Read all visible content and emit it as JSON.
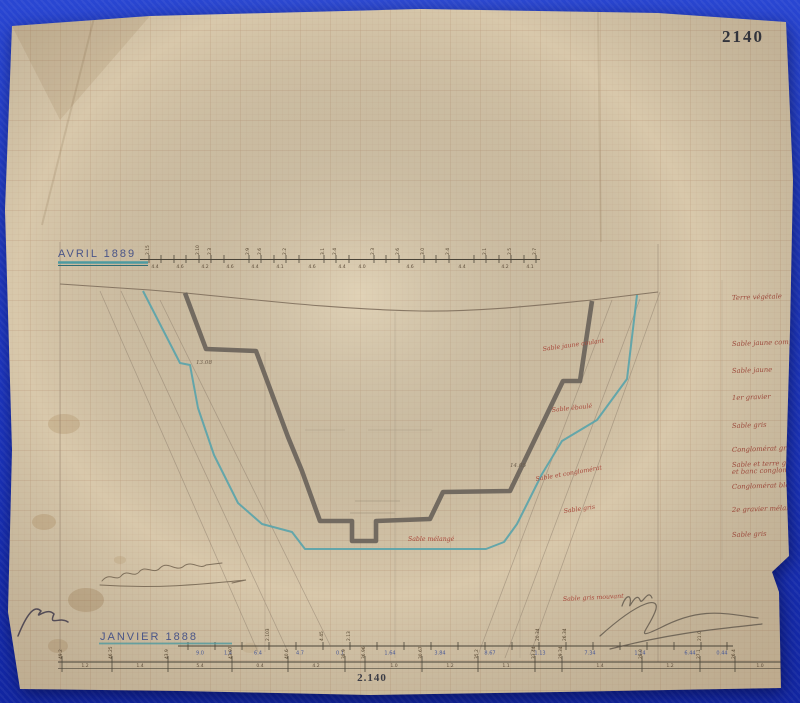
{
  "sheet": {
    "plate_number": "2140",
    "plate_number_footer": "2.140",
    "paper_color": "#d8c8ab",
    "grid_color": "#ab7a56",
    "backdrop_color": "#1d36c0",
    "profile_1888_color": "#6a635a",
    "profile_1889_color": "#58a3ab",
    "label_blue": "#4a5588",
    "label_red": "#9c4a3c"
  },
  "scales": {
    "top": {
      "label": "AVRIL 1889",
      "ticks": [
        149,
        161,
        174,
        186,
        199,
        211,
        224,
        249,
        261,
        274,
        286,
        299,
        324,
        336,
        349,
        374,
        386,
        399,
        424,
        436,
        449,
        474,
        486,
        499,
        511,
        524,
        536
      ],
      "upper": [
        {
          "x": 149,
          "v": "2.15"
        },
        {
          "x": 199,
          "v": "2.10"
        },
        {
          "x": 211,
          "v": "2.3"
        },
        {
          "x": 249,
          "v": "2.9"
        },
        {
          "x": 261,
          "v": "2.6"
        },
        {
          "x": 286,
          "v": "2.2"
        },
        {
          "x": 324,
          "v": "3.1"
        },
        {
          "x": 336,
          "v": "2.4"
        },
        {
          "x": 374,
          "v": "2.3"
        },
        {
          "x": 399,
          "v": "2.6"
        },
        {
          "x": 424,
          "v": "3.0"
        },
        {
          "x": 449,
          "v": "2.4"
        },
        {
          "x": 486,
          "v": "2.1"
        },
        {
          "x": 511,
          "v": "2.5"
        },
        {
          "x": 536,
          "v": "2.7"
        }
      ],
      "lower": [
        {
          "x": 155,
          "v": "4.4"
        },
        {
          "x": 180,
          "v": "4.6"
        },
        {
          "x": 205,
          "v": "4.2"
        },
        {
          "x": 230,
          "v": "4.6"
        },
        {
          "x": 255,
          "v": "4.4"
        },
        {
          "x": 280,
          "v": "4.1"
        },
        {
          "x": 312,
          "v": "4.6"
        },
        {
          "x": 342,
          "v": "4.4"
        },
        {
          "x": 362,
          "v": "4.0"
        },
        {
          "x": 410,
          "v": "4.6"
        },
        {
          "x": 462,
          "v": "4.4"
        },
        {
          "x": 505,
          "v": "4.2"
        },
        {
          "x": 530,
          "v": "4.1"
        }
      ]
    },
    "mid": {
      "label": "JANVIER 1888",
      "ticks": [
        188,
        215,
        242,
        269,
        296,
        323,
        350,
        377,
        404,
        431,
        458,
        485,
        512,
        539,
        566,
        593,
        620,
        647,
        674,
        701,
        727
      ],
      "below": [
        {
          "x": 200,
          "v": "9.0"
        },
        {
          "x": 228,
          "v": "1.4"
        },
        {
          "x": 258,
          "v": "6.4"
        },
        {
          "x": 300,
          "v": "4.7"
        },
        {
          "x": 340,
          "v": "0.1"
        },
        {
          "x": 390,
          "v": "1.64"
        },
        {
          "x": 440,
          "v": "3.84"
        },
        {
          "x": 490,
          "v": "8.67"
        },
        {
          "x": 540,
          "v": "1.13"
        },
        {
          "x": 590,
          "v": "7.34"
        },
        {
          "x": 640,
          "v": "1.14"
        },
        {
          "x": 690,
          "v": "6.44"
        },
        {
          "x": 722,
          "v": "0.44"
        }
      ],
      "above": [
        {
          "x": 269,
          "v": "2.103"
        },
        {
          "x": 323,
          "v": "4.45"
        },
        {
          "x": 350,
          "v": "2.13"
        },
        {
          "x": 539,
          "v": "20.34"
        },
        {
          "x": 566,
          "v": "26.34"
        },
        {
          "x": 701,
          "v": "21.0"
        }
      ]
    },
    "base": {
      "ticks": [
        62,
        112,
        168,
        232,
        288,
        345,
        365,
        422,
        478,
        535,
        562,
        642,
        700,
        735,
        790
      ],
      "rotated": [
        {
          "x": 62,
          "v": "49.2"
        },
        {
          "x": 112,
          "v": "46.25"
        },
        {
          "x": 168,
          "v": "43.9"
        },
        {
          "x": 232,
          "v": "43.97"
        },
        {
          "x": 288,
          "v": "40.6"
        },
        {
          "x": 345,
          "v": "38.9"
        },
        {
          "x": 365,
          "v": "36.96"
        },
        {
          "x": 422,
          "v": "30.67"
        },
        {
          "x": 478,
          "v": "35.2"
        },
        {
          "x": 535,
          "v": "33.44"
        },
        {
          "x": 562,
          "v": "29.34"
        },
        {
          "x": 642,
          "v": "28.0"
        },
        {
          "x": 700,
          "v": "27.1"
        },
        {
          "x": 735,
          "v": "26.4"
        },
        {
          "x": 790,
          "v": "25.42"
        }
      ],
      "inline": [
        {
          "x": 85,
          "v": "1.2"
        },
        {
          "x": 140,
          "v": "1.4"
        },
        {
          "x": 200,
          "v": "5.4"
        },
        {
          "x": 260,
          "v": "0.4"
        },
        {
          "x": 316,
          "v": "4.2"
        },
        {
          "x": 394,
          "v": "1.0"
        },
        {
          "x": 450,
          "v": "1.2"
        },
        {
          "x": 506,
          "v": "1.1"
        },
        {
          "x": 600,
          "v": "1.4"
        },
        {
          "x": 670,
          "v": "1.2"
        },
        {
          "x": 760,
          "v": "1.0"
        }
      ]
    }
  },
  "strata_labels": [
    {
      "y": 300,
      "text": "Terre végétale"
    },
    {
      "y": 346,
      "text": "Sable jaune compact"
    },
    {
      "y": 373,
      "text": "Sable jaune"
    },
    {
      "y": 400,
      "text": "1er gravier"
    },
    {
      "y": 428,
      "text": "Sable gris"
    },
    {
      "y": 452,
      "text": "Conglomérat gris"
    },
    {
      "y": 467,
      "text": "Sable et terre glaise"
    },
    {
      "y": 474,
      "text": "et banc conglomérat"
    },
    {
      "y": 489,
      "text": "Conglomérat bleuâtre"
    },
    {
      "y": 512,
      "text": "2e gravier mélangé"
    },
    {
      "y": 537,
      "text": "Sable gris"
    }
  ],
  "profile_annotations": [
    {
      "x": 543,
      "y": 351,
      "rot": -8,
      "text": "Sable jaune coulant"
    },
    {
      "x": 552,
      "y": 412,
      "rot": -6,
      "text": "Sable éboulé"
    },
    {
      "x": 536,
      "y": 481,
      "rot": -10,
      "text": "Sable et conglomérat"
    },
    {
      "x": 564,
      "y": 513,
      "rot": -8,
      "text": "Sable gris"
    },
    {
      "x": 408,
      "y": 541,
      "rot": 0,
      "text": "Sable mélangé"
    },
    {
      "x": 563,
      "y": 601,
      "rot": -3,
      "text": "Sable gris mouvant"
    }
  ],
  "measure_notes": [
    {
      "x": 196,
      "y": 364,
      "text": "13.08"
    },
    {
      "x": 510,
      "y": 467,
      "text": "14.05"
    }
  ]
}
